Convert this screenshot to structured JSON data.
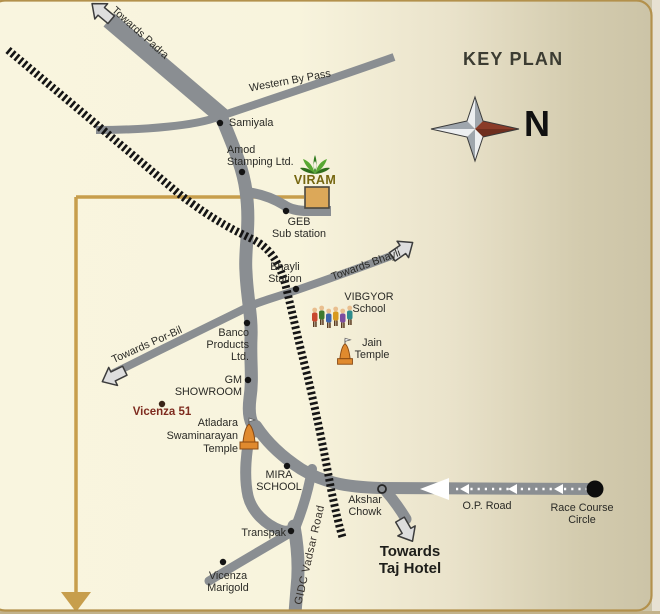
{
  "header": {
    "title": "KEY PLAN",
    "north": "N"
  },
  "site": {
    "name": "VIRAM"
  },
  "road_labels": {
    "padra": "Towards Padra",
    "western_bypass": "Western By Pass",
    "bhayli": "Towards Bhayli",
    "por_bil": "Towards Por-Bil",
    "gidc": "GIDC Vadsar Road",
    "op_road": "O.P. Road",
    "taj": "Towards\nTaj Hotel"
  },
  "landmarks": {
    "samiyala": "Samiyala",
    "amod": "Amod\nStamping Ltd.",
    "geb": "GEB\nSub station",
    "bhayli_station": "Bhayli\nStation",
    "vibgyor": "VIBGYOR\nSchool",
    "jain": "Jain\nTemple",
    "banco": "Banco\nProducts\nLtd.",
    "gm": "GM\nSHOWROOM",
    "vicenza51": "Vicenza 51",
    "atladara": "Atladara\nSwaminarayan\nTemple",
    "mira": "MIRA\nSCHOOL",
    "transpak": "Transpak",
    "akshar": "Akshar\nChowk",
    "marigold": "Vicenza\nMarigold",
    "race_course": "Race Course\nCircle"
  },
  "colors": {
    "background_left": "#F9F5DF",
    "background_right": "#CBC3A6",
    "road": "#8A8E92",
    "railway": "#151515",
    "gold_route": "#C79E4C",
    "site_building": "#DCA859",
    "accent_maroon": "#7E2B1F",
    "compass_red": "#8A3B28"
  }
}
